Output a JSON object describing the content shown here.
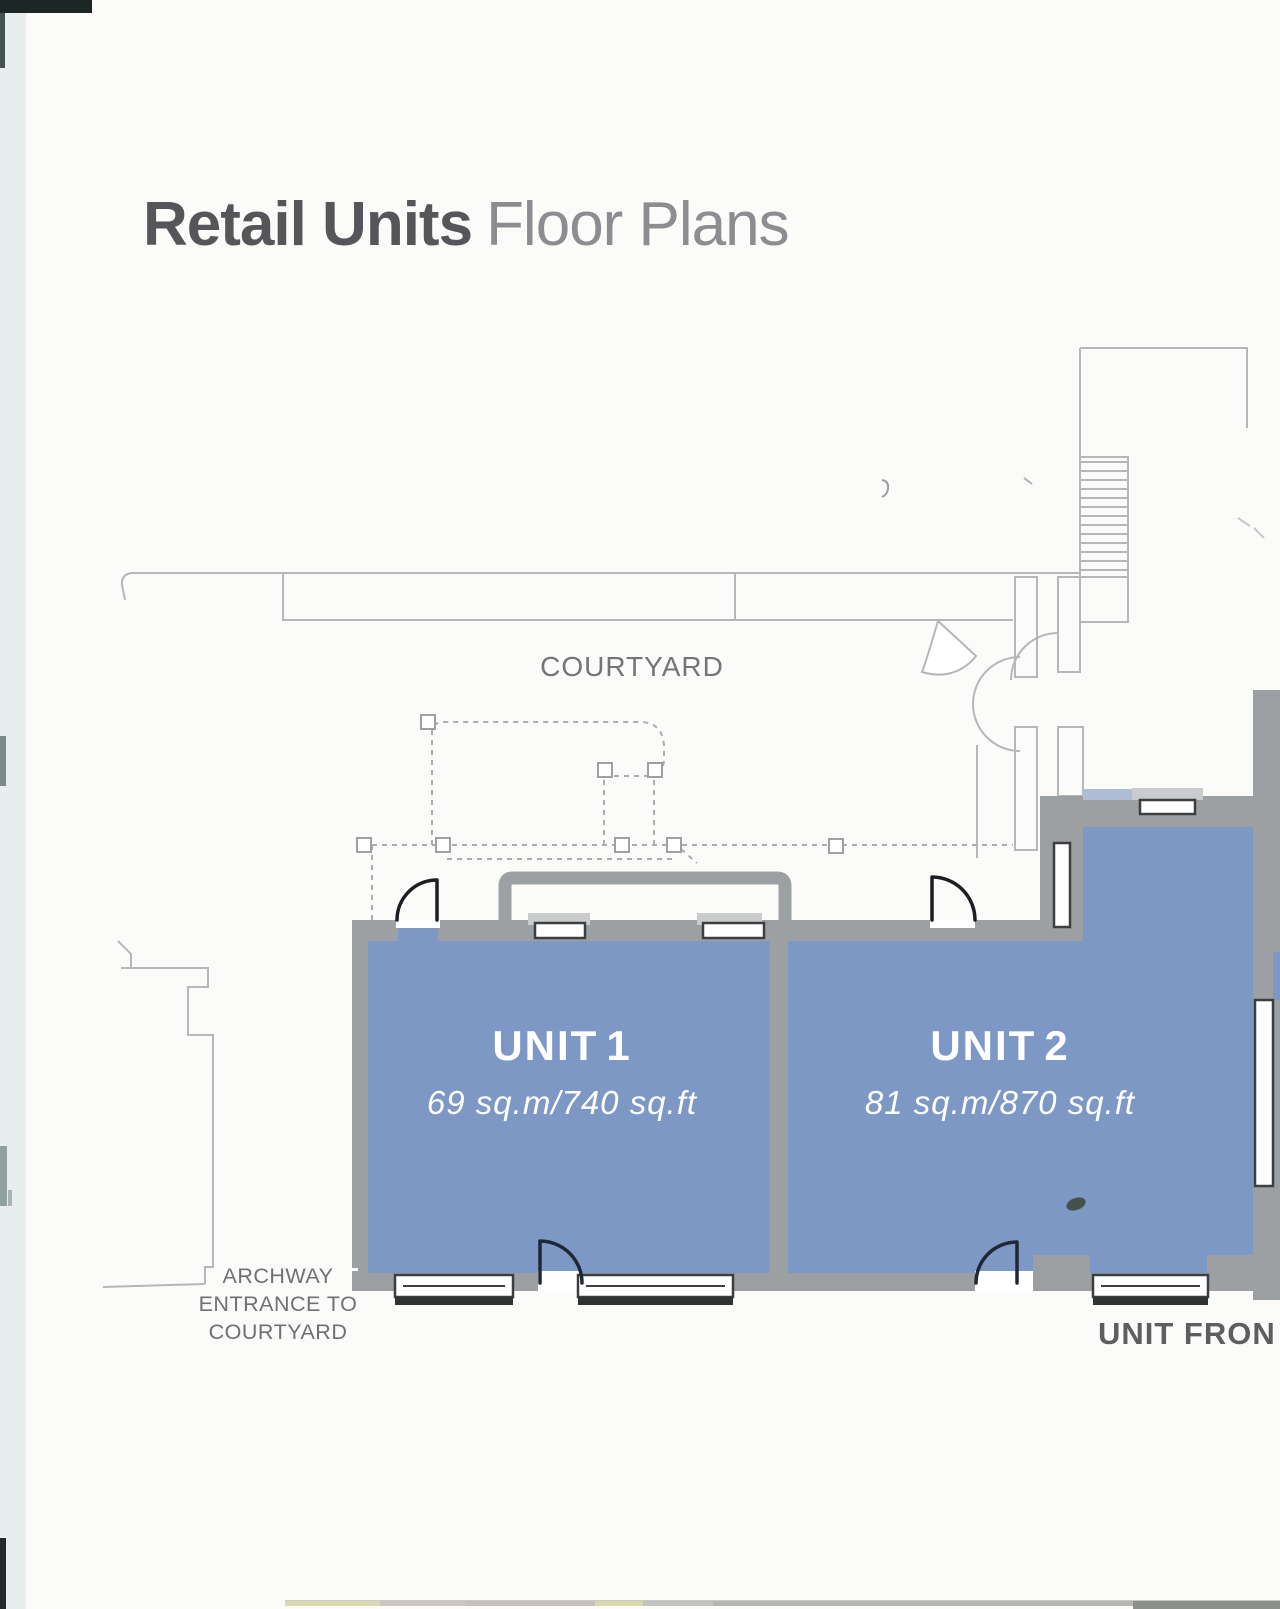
{
  "document": {
    "title": {
      "primary": "Retail Units",
      "secondary": "Floor Plans"
    }
  },
  "floor_plan": {
    "courtyard_label": "COURTYARD",
    "units": [
      {
        "prefix": "UNIT",
        "number": "1",
        "area": "69 sq.m/740 sq.ft"
      },
      {
        "prefix": "UNIT",
        "number": "2",
        "area": "81 sq.m/870 sq.ft"
      }
    ],
    "archway": {
      "lines": [
        "ARCHWAY",
        "ENTRANCE TO",
        "COURTYARD"
      ]
    },
    "frontage_label": "UNIT FRON"
  },
  "colors": {
    "unit-fill": "#7E98C6",
    "wall-gray": "#9DA0A2",
    "plan-line": "#B5B7B9",
    "door-dark": "#1F2734",
    "window-border": "#3C3E40",
    "sill-gray": "#C9CBCD",
    "title-dark": "#55565A",
    "title-light": "#8B8D90",
    "label-gray": "#6E7072",
    "page-bg": "#FBFBF9",
    "scan-edge": "#E8EDEE"
  }
}
